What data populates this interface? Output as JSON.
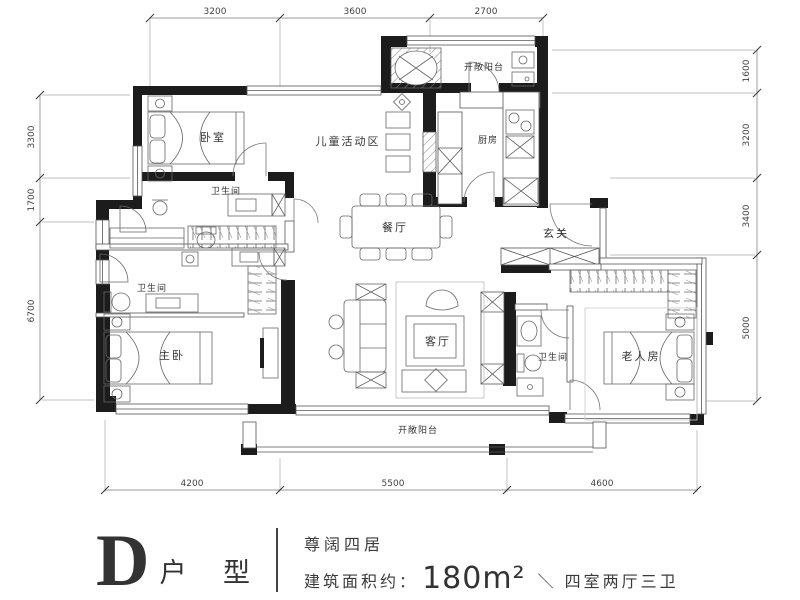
{
  "plan": {
    "rooms": {
      "bedroom": "卧室",
      "children_area": "儿童活动区",
      "balcony_top": "开敞阳台",
      "kitchen": "厨房",
      "bath_top": "卫生间",
      "dining": "餐厅",
      "foyer": "玄关",
      "bath_mid": "卫生间",
      "master_bedroom": "主卧",
      "living": "客厅",
      "bath_right": "卫生间",
      "elderly_room": "老人房",
      "balcony_bottom": "开敞阳台"
    },
    "dimensions": {
      "top": [
        "3200",
        "3600",
        "2700"
      ],
      "bottom": [
        "4200",
        "5500",
        "4600"
      ],
      "left": [
        "3300",
        "1700",
        "6700"
      ],
      "right": [
        "1600",
        "3200",
        "3400",
        "5000"
      ]
    }
  },
  "title_block": {
    "unit_letter": "D",
    "unit_label": "户 型",
    "tagline": "尊阔四居",
    "area_label": "建筑面积约：",
    "area_value": "180m²",
    "separator": "＼",
    "spec": "四室两厅三卫"
  },
  "colors": {
    "wall": "#1c1c1c",
    "line": "#555555",
    "text": "#3a3a3a"
  }
}
